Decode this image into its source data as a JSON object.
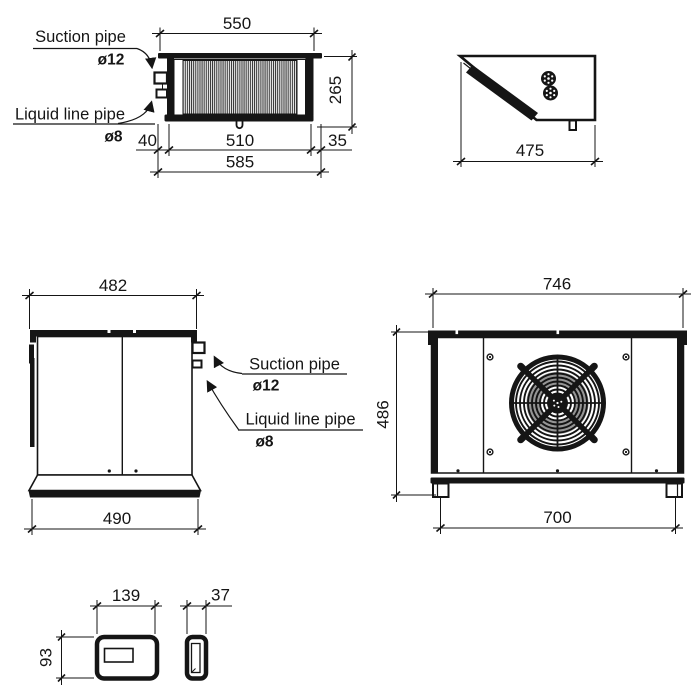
{
  "drawing": {
    "background": "#ffffff",
    "line_color": "#151515",
    "views": {
      "top": {
        "dim_flange_width": "550",
        "dim_depth": "265",
        "dim_pipe_offset": "40",
        "dim_body_width": "510",
        "dim_right_offset": "35",
        "dim_overall_width": "585",
        "label_suction": "Suction pipe",
        "label_suction_dia": "ø12",
        "label_liquid": "Liquid line pipe",
        "label_liquid_dia": "ø8"
      },
      "side": {
        "dim_depth": "475"
      },
      "front": {
        "dim_top_width": "482",
        "dim_base_width": "490",
        "label_suction": "Suction pipe",
        "label_suction_dia": "ø12",
        "label_liquid": "Liquid line pipe",
        "label_liquid_dia": "ø8"
      },
      "rear": {
        "dim_overall_width": "746",
        "dim_height": "486",
        "dim_feet_span": "700"
      },
      "controller": {
        "dim_width": "139",
        "dim_height": "93",
        "dim_depth": "37"
      }
    }
  }
}
